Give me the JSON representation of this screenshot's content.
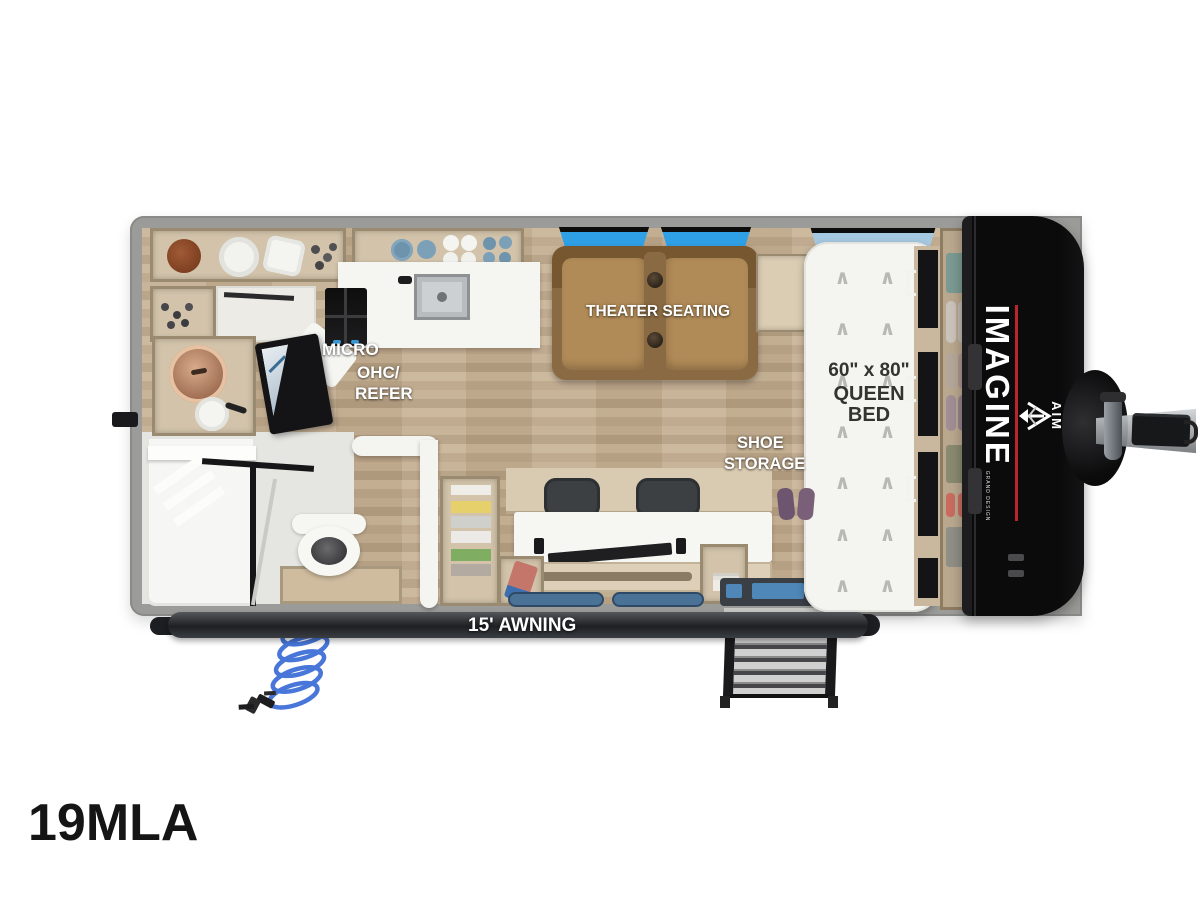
{
  "model": "19MLA",
  "labels": {
    "micro_line1": "MICRO",
    "micro_line2": "OHC/",
    "micro_line3": "REFER",
    "theater_seating": "THEATER SEATING",
    "bed_size": "60\" x 80\"",
    "bed_type_line1": "QUEEN",
    "bed_type_line2": "BED",
    "shoe_line1": "SHOE",
    "shoe_line2": "STORAGE",
    "awning": "15' AWNING"
  },
  "branding": {
    "imagine_wordmark": "IMAGINE",
    "imagine_tagline": "GRAND DESIGN",
    "series": "AIM"
  },
  "icons": {
    "chevron_up": "∧"
  },
  "colors": {
    "wall_gray": "#9b9b99",
    "bath_floor": "#e5e5e1",
    "cabinet_wood": "#d2c3aa",
    "cabinet_border": "#9a8a6f",
    "counter_white": "#f5f5f2",
    "sofa_brown": "#b08a57",
    "window_blue": "#2f9fe6",
    "bed_window_blue": "#a6c9e2",
    "cap_black": "#0b0b0c",
    "accent_red": "#b9252b",
    "awning_dark": "#26282b",
    "hose_blue": "#3f6fd8"
  }
}
